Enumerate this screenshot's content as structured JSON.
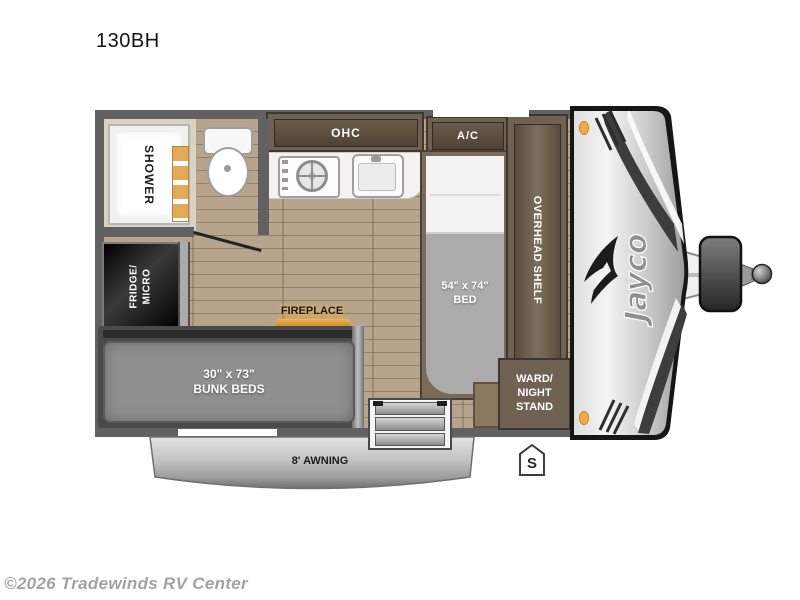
{
  "page": {
    "title": "130BH",
    "copyright": "©2026 Tradewinds RV Center"
  },
  "brand": {
    "name": "Jayco"
  },
  "rooms": {
    "shower": "SHOWER",
    "fridge_micro": "FRIDGE/\nMICRO",
    "ohc": "OHC",
    "ac": "A/C",
    "bed": "54\" x 74\"\nBED",
    "overhead_shelf": "OVERHEAD SHELF",
    "wardrobe": "WARD/\nNIGHT\nSTAND",
    "fireplace": "FIREPLACE",
    "bunk_beds": "30\" x 73\"\nBUNK BEDS",
    "awning": "8' AWNING",
    "door_side_marker": "S"
  },
  "colors": {
    "wall": "#616161",
    "floor_wood": "#b6a48c",
    "cabinet_dark": "#4e4336",
    "cabinet_mid": "#6f6252",
    "amber_accent": "#f0a843",
    "fireplace_glow": "#e9a43b",
    "mattress_gray": "#8f8f8f",
    "awning_silver": "#c6c6c6"
  }
}
